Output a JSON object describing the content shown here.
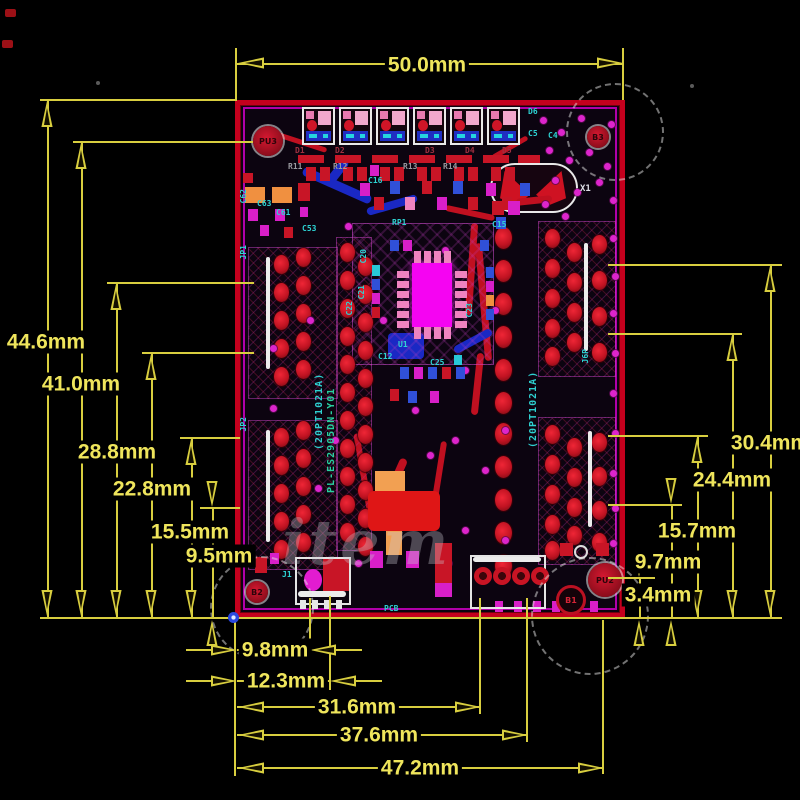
{
  "dims": {
    "top": "50.0mm",
    "left": [
      "44.6mm",
      "41.0mm",
      "28.8mm",
      "22.8mm",
      "15.5mm",
      "9.5mm"
    ],
    "right": [
      "30.4mm",
      "24.4mm",
      "15.7mm",
      "9.7mm",
      "3.4mm"
    ],
    "bottom": [
      "9.8mm",
      "12.3mm",
      "31.6mm",
      "37.6mm",
      "47.2mm"
    ]
  },
  "board": {
    "refs": {
      "pu3": "PU3",
      "pu2": "PU2",
      "b1": "B1",
      "b2": "B2",
      "b3": "B3",
      "x1": "X1",
      "u1": "U1",
      "j1": "J1",
      "jp1": "JP1",
      "jp2": "JP2",
      "j6p": "J6P",
      "pcb": "PCB",
      "d1": "D1",
      "d2": "D2",
      "d3": "D3",
      "d4": "D4",
      "d5": "D5",
      "d6": "D6",
      "r11": "R11",
      "r12": "R12",
      "r13": "R13",
      "r14": "R14",
      "c4": "C4",
      "c5": "C5",
      "c12": "C12",
      "c15": "C15",
      "c16": "C16",
      "c20": "C20",
      "c21": "C21",
      "c22": "C22",
      "c23": "C23",
      "c25": "C25",
      "c53": "C53",
      "c61": "C61",
      "c62": "C62",
      "c63": "C63",
      "rp1": "RP1"
    },
    "silk": {
      "line1": "(20PT1021A)",
      "line2": "PL-ES2905DN-Y01",
      "line3": "(20PT1021A)"
    },
    "colors": {
      "dimension_yellow": "#d8ce3f",
      "board_border_red": "#c4001d",
      "inner_outline_magenta": "#cf00c4",
      "pad_red": "#c11322",
      "via_magenta": "#dd25cc",
      "ic_core_magenta": "#f504f2",
      "silkscreen_cyan": "#2dd3d3"
    }
  },
  "watermark": {
    "text": "item"
  }
}
